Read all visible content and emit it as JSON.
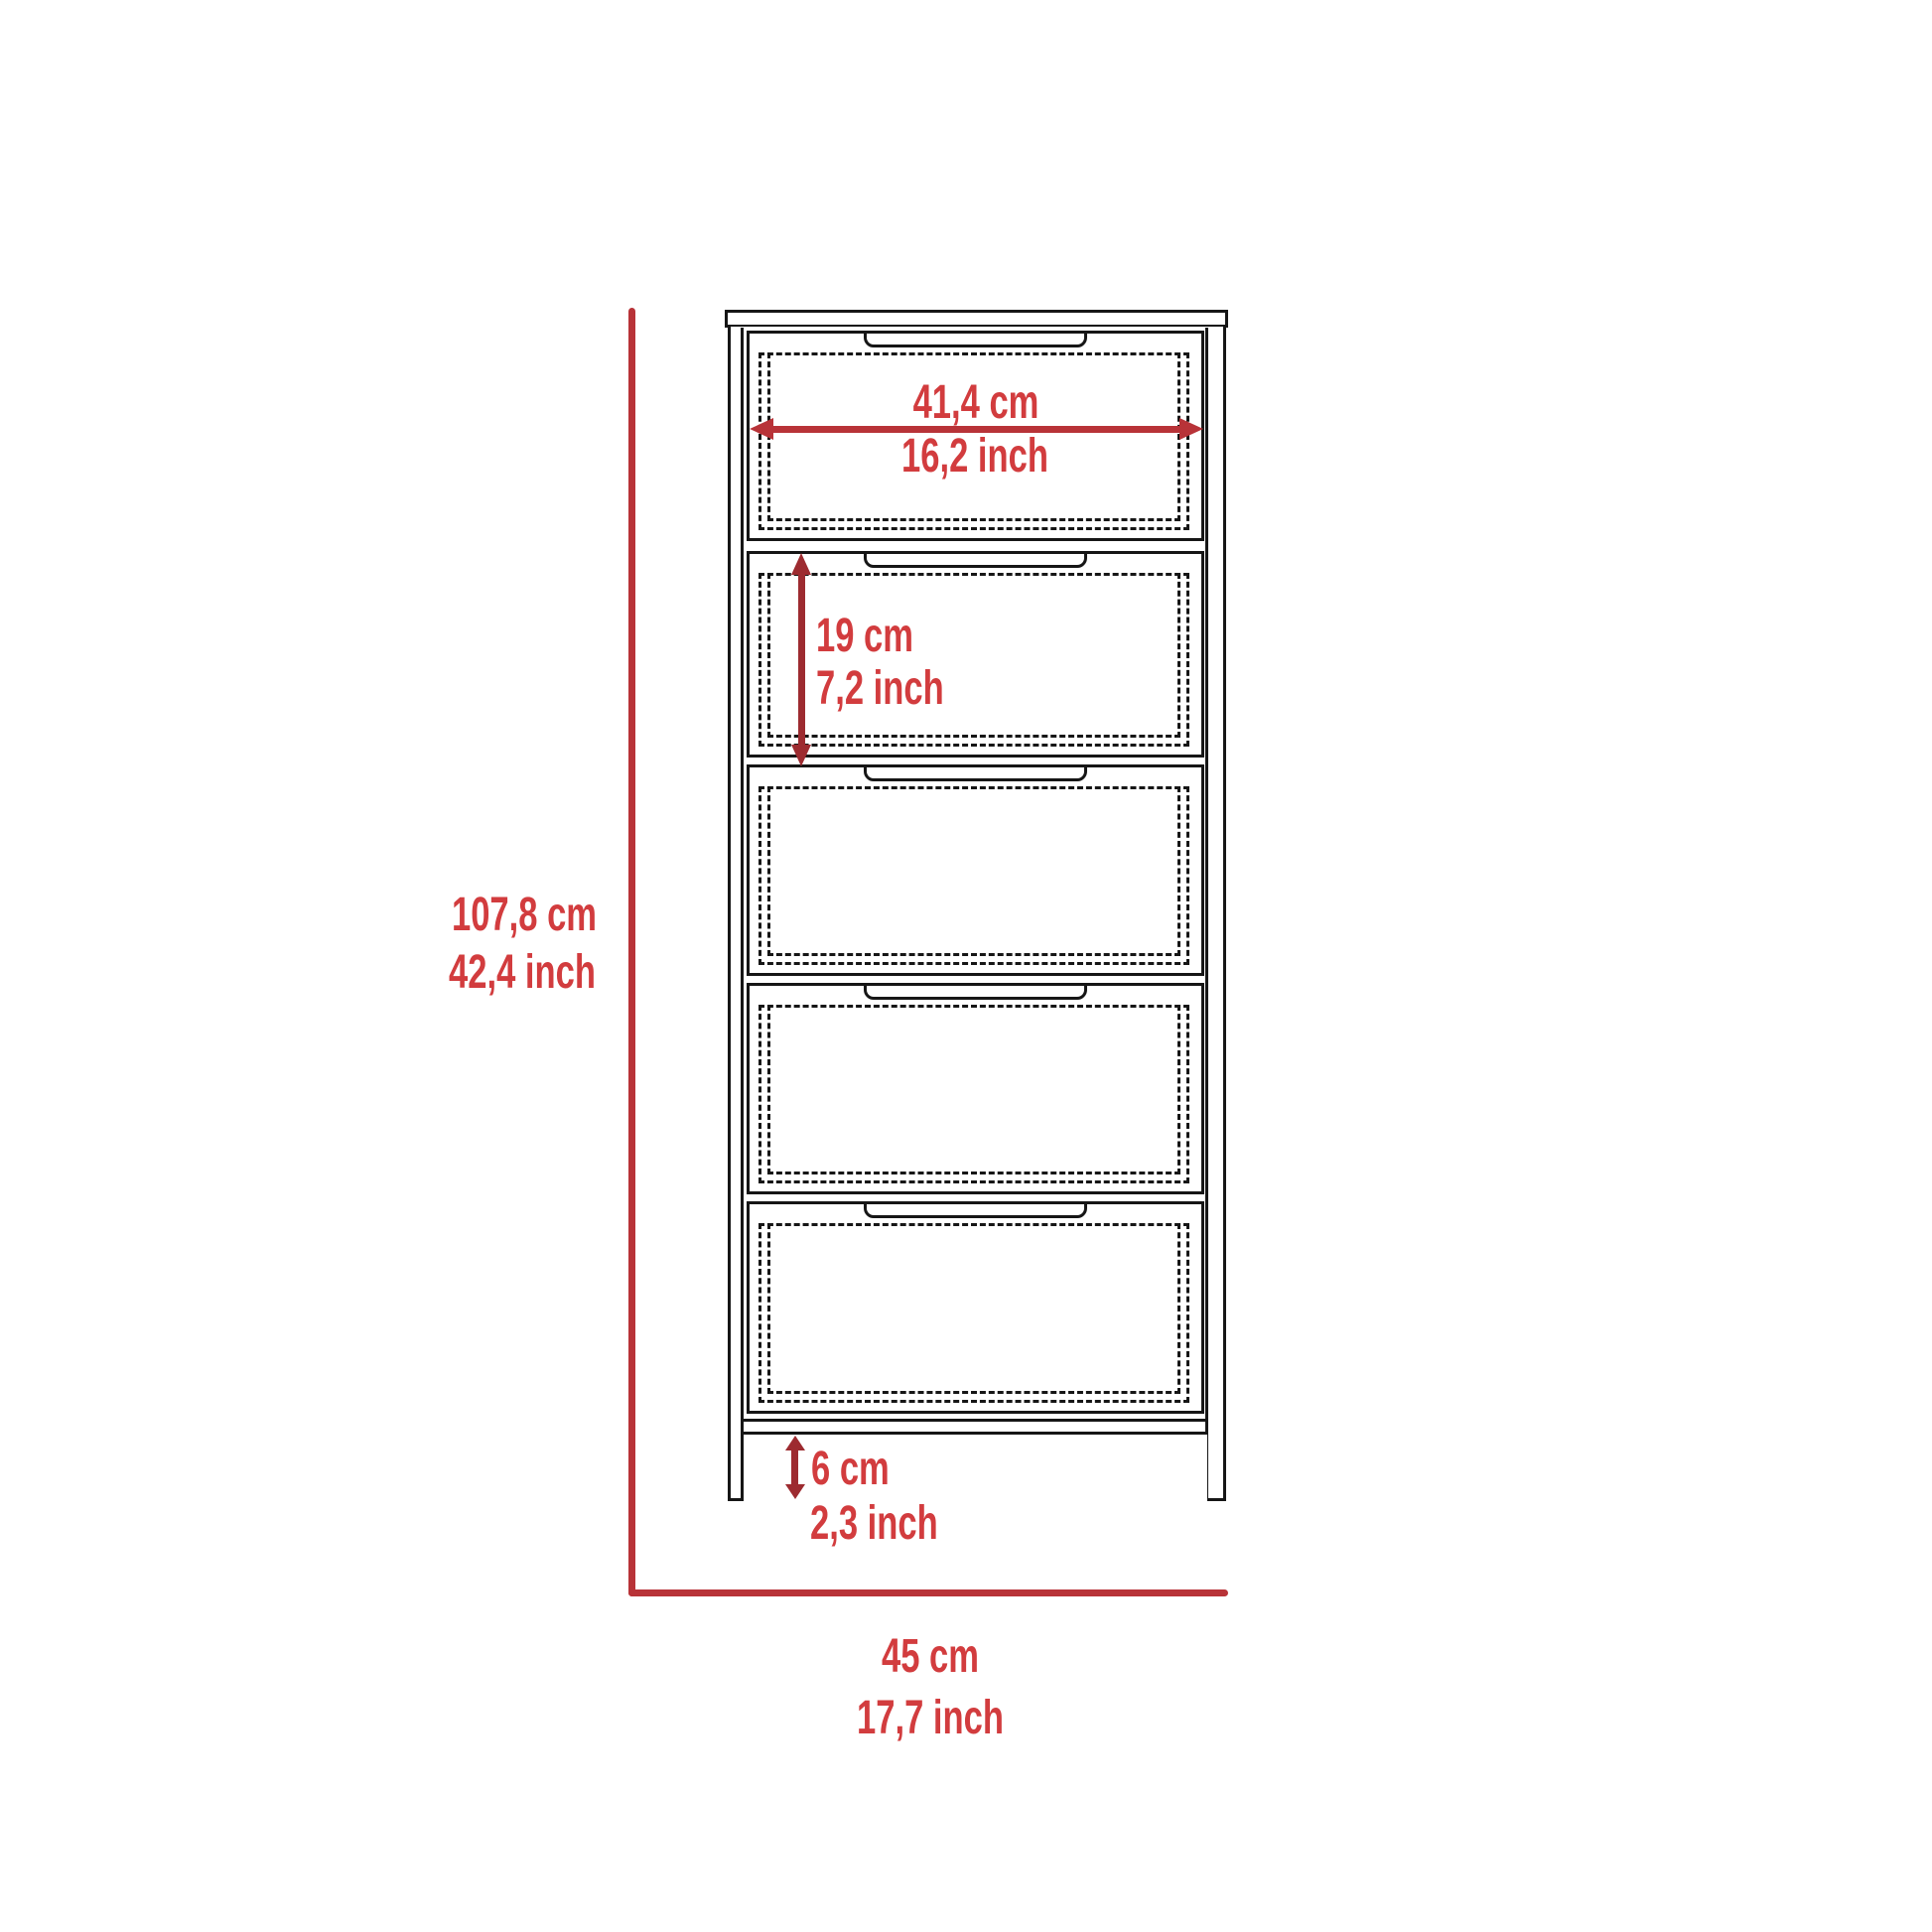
{
  "colors": {
    "background": "#ffffff",
    "diagram_black": "#161616",
    "dimension_red": "#b83338",
    "arrow_red": "#9d2b30",
    "text_red": "#d23c3e"
  },
  "structure": {
    "drawer_count": 5
  },
  "dimensions": {
    "overall_height": {
      "cm": "107,8 cm",
      "inch": "42,4 inch"
    },
    "drawer_width": {
      "cm": "41,4 cm",
      "inch": "16,2 inch"
    },
    "drawer_height": {
      "cm": "19 cm",
      "inch": "7,2 inch"
    },
    "base_height": {
      "cm": "6 cm",
      "inch": "2,3 inch"
    },
    "overall_width": {
      "cm": "45 cm",
      "inch": "17,7 inch"
    }
  }
}
